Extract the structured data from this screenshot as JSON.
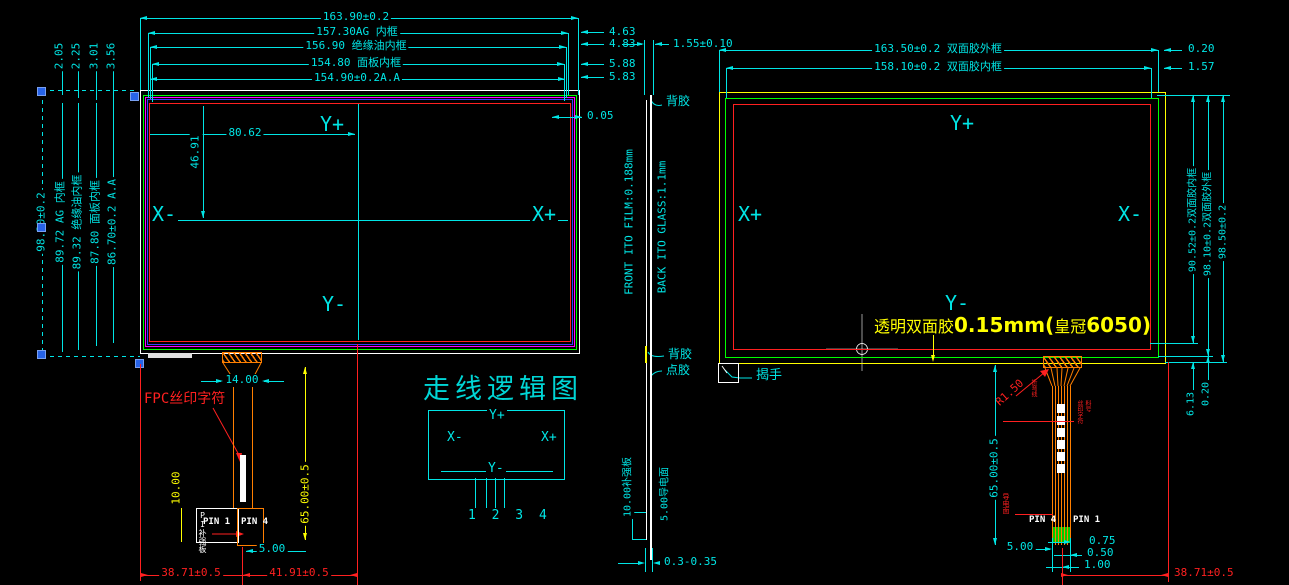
{
  "colors": {
    "cyan": "#00e5e5",
    "red": "#ff2020",
    "yellow": "#ffff00",
    "orange": "#ff7f00",
    "green": "#00ff00",
    "magenta": "#ff00ff",
    "blue": "#3a3aff",
    "grip_blue": "#2763e8",
    "white": "#ffffff"
  },
  "left": {
    "top_dims": [
      "163.90±0.2",
      "157.30AG 内框",
      "156.90  绝缘油内框",
      "154.80 面板内框",
      "154.90±0.2A.A"
    ],
    "right_gap_dims": [
      "4.63",
      "4.83",
      "5.88",
      "5.83"
    ],
    "corner_gap_dims": [
      "2.05",
      "2.25",
      "3.01",
      "3.56"
    ],
    "side_dims": [
      "98.30±0.2",
      "89.72 AG 内框",
      "89.32 绝缘油内框",
      "87.80 面板内框",
      "86.70±0.2 A.A"
    ],
    "edge_gap_dim": "0.05",
    "center_x_dim": "80.62",
    "center_y_dim": "46.91",
    "axis_top": "Y+",
    "axis_left": "X-",
    "axis_right": "X+",
    "axis_bottom": "Y-",
    "fpc_silk_label": "FPC丝印字符",
    "fpc_width_dim": "14.00",
    "stiffener_dim": "10.00",
    "tail_length_dim": "65.00±0.5",
    "pitch_dim": "5.00",
    "pin_left": "PIN 1",
    "pin_right": "PIN 4",
    "stiffener_label": "PI补强板",
    "bottom_dim_left": "38.71±0.5",
    "bottom_dim_right": "41.91±0.5"
  },
  "side": {
    "thickness_dim": "1.55±0.10",
    "film_label": "FRONT ITO FILM:0.188mm",
    "glass_label": "BACK ITO GLASS:1.1mm",
    "glue_top": "背胶",
    "glue_bottom": "背胶",
    "dot_glue": "点胶",
    "stiffener_dim": "10.00补强板",
    "conductive_dim": "5.00导电面",
    "gap_dim": "0.3-0.35"
  },
  "logic": {
    "title": "走线逻辑图",
    "axis_top": "Y+",
    "axis_left": "X-",
    "axis_right": "X+",
    "axis_bottom": "Y-",
    "pins": "1 2 3 4"
  },
  "right": {
    "top_dims": [
      "163.50±0.2 双面胶外框",
      "158.10±0.2 双面胶内框"
    ],
    "top_right_dims": [
      "0.20",
      "1.57"
    ],
    "side_dims": [
      "90.52±0.2双面胶内框",
      "98.10±0.2双面胶外框",
      "98.50±0.2"
    ],
    "bottom_gap_dims": [
      "6.13",
      "0.20"
    ],
    "axis_top": "Y+",
    "axis_left": "X+",
    "axis_right": "X-",
    "axis_bottom": "Y-",
    "note_part1": "透明双面胶",
    "note_part2": "0.15mm(",
    "note_part3": "皇冠",
    "note_part4": "6050)",
    "peel_label": "揭手",
    "radius_label": "R1.50",
    "bend_note": "折弯线",
    "silk_note_a": "丝印字符",
    "silk_note_b": "料号",
    "conductive_note": "导电面",
    "tail_length_dim": "65.00±0.5",
    "pitch_dim": "5.00",
    "pad_dims": [
      "0.75",
      "0.50",
      "1.00"
    ],
    "pin_left": "PIN 4",
    "pin_right": "PIN 1",
    "bottom_dim": "38.71±0.5"
  }
}
